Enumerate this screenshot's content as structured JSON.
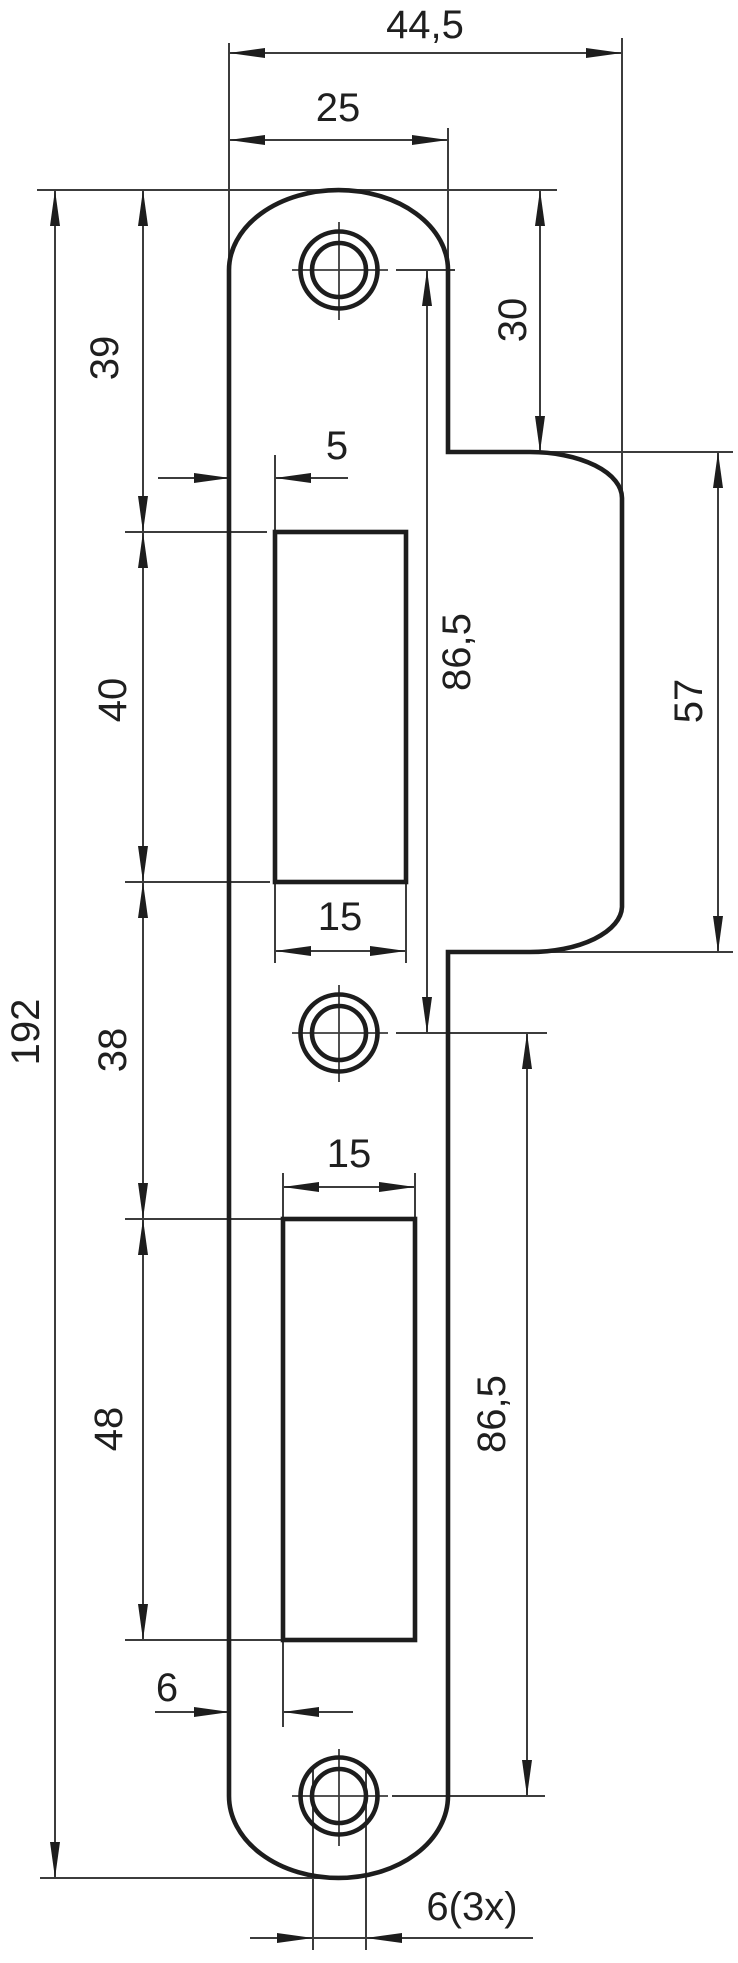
{
  "drawing": {
    "type": "technical-drawing",
    "part": "door lock strike plate - front view with dimensions",
    "units": "mm",
    "dims": {
      "overall_width": "44,5",
      "plate_width": "25",
      "upper_cutout_offset": "5",
      "upper_cutout_width": "15",
      "lower_cutout_width": "15",
      "lower_cutout_offset": "6",
      "hole_diameter": "6(3x)",
      "top_to_upper_cutout": "39",
      "upper_cutout_height": "40",
      "between_cutouts": "38",
      "lower_cutout_height": "48",
      "total_height": "192",
      "lip_top_offset": "30",
      "upper_hole_pitch": "86,5",
      "lower_hole_pitch": "86,5",
      "lip_height": "57"
    },
    "colors": {
      "line": "#1d1d1d",
      "thin_line": "#3c3c3c",
      "background": "#ffffff"
    }
  }
}
